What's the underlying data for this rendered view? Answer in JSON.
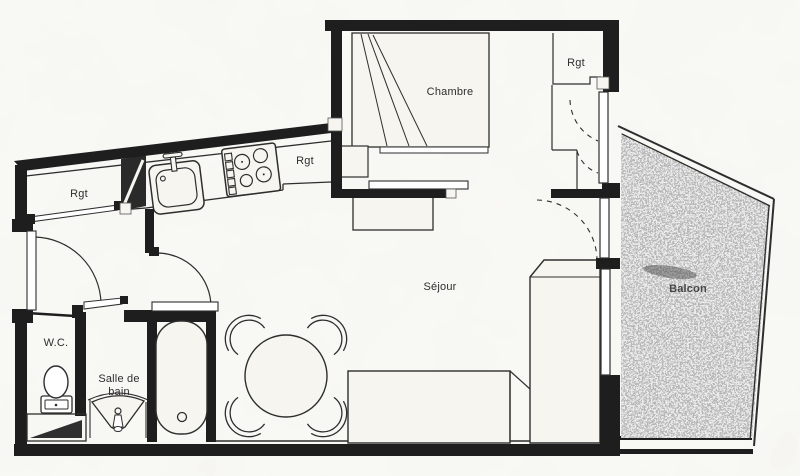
{
  "colors": {
    "paper": "#f6f5f0",
    "ink": "#2e2e2e",
    "wall": "#1e1e1e",
    "balcony_speckle": "#8e8e8e"
  },
  "rooms": {
    "chambre": {
      "label": "Chambre"
    },
    "sejour": {
      "label": "Séjour"
    },
    "balcon": {
      "label": "Balcon"
    },
    "wc": {
      "label": "W.C."
    },
    "salle_de_bain": {
      "label_line1": "Salle de",
      "label_line2": "bain"
    },
    "rgt_entry": {
      "label": "Rgt"
    },
    "rgt_kitchen": {
      "label": "Rgt"
    },
    "rgt_dressing": {
      "label": "Rgt"
    }
  },
  "fixtures": [
    "bed",
    "night-table",
    "sliding-door",
    "wardrobe-storage",
    "kitchen-sink",
    "stove-burners",
    "duct-shaft",
    "dining-table",
    "chairs",
    "sofa",
    "tall-cabinet",
    "bathtub",
    "washbasin",
    "toilet",
    "door-swings",
    "windows",
    "balcony-railing"
  ]
}
